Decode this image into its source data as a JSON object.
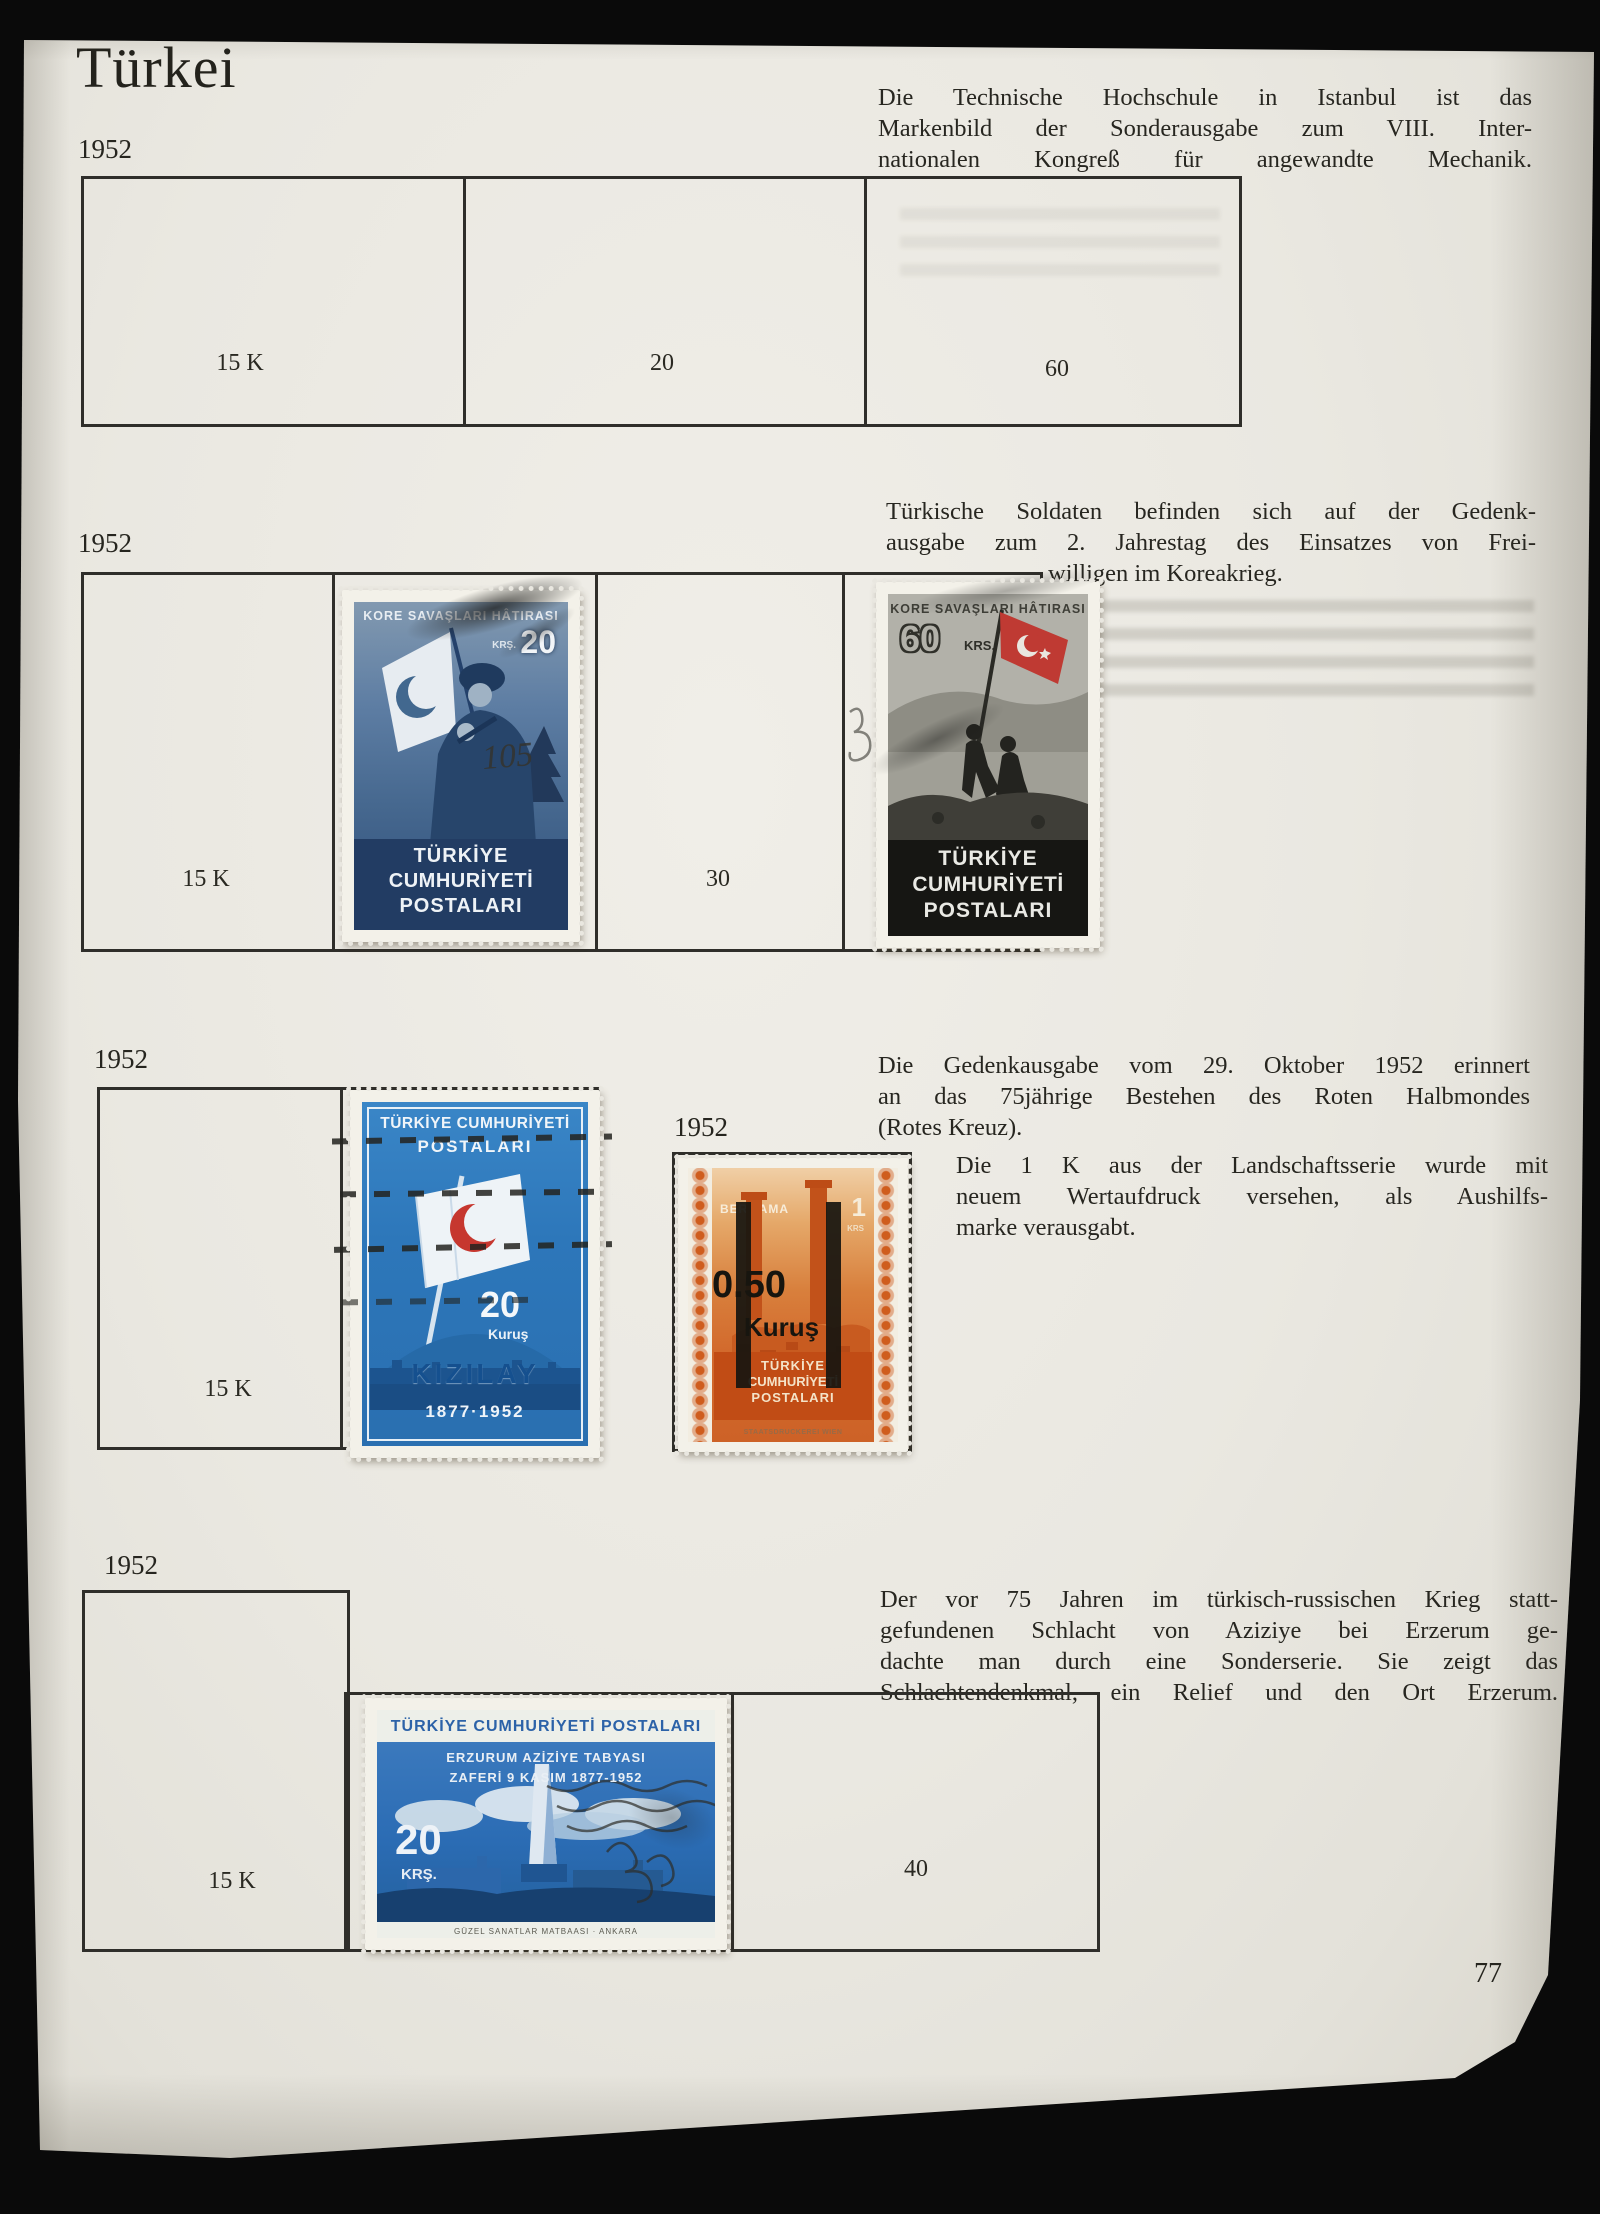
{
  "page": {
    "title": "Türkei",
    "number": "77"
  },
  "colors": {
    "paper": "#eae8e1",
    "ink": "#26251f",
    "box_line": "#2e2d29",
    "korea20_blue": "#4d6e96",
    "korea20_panel": "#223c63",
    "korea60_flag_red": "#bf3a33",
    "korea60_panel": "#171714",
    "kizilay_blue": "#2f7cc0",
    "crescent_red": "#c6372f",
    "bergama_orange": "#d55d22",
    "bergama_panel": "#c14c15",
    "erzurum_blue": "#2b6cb4"
  },
  "sections": {
    "s1": {
      "year": "1952",
      "para": [
        "Die Technische Hochschule in Istanbul ist das",
        "Markenbild der Sonderausgabe zum VIII. Inter-",
        "nationalen Kongreß für angewandte Mechanik."
      ],
      "cell1": "15 K",
      "cell2": "20",
      "cell3": "60"
    },
    "s2": {
      "year": "1952",
      "para": [
        "Türkische Soldaten befinden sich auf der Gedenk-",
        "ausgabe zum 2. Jahrestag des Einsatzes von Frei-",
        "willigen im Koreakrieg."
      ],
      "cell1": "15 K",
      "cell2": "30"
    },
    "s3": {
      "year": "1952",
      "para": [
        "Die Gedenkausgabe vom 29. Oktober 1952 erinnert",
        "an das 75jährige Bestehen des Roten Halbmondes",
        "(Rotes Kreuz)."
      ],
      "year2": "1952",
      "para2": [
        "Die 1 K aus der Landschaftsserie wurde mit",
        "neuem Wertaufdruck versehen, als Aushilfs-",
        "marke verausgabt."
      ],
      "cell1": "15 K"
    },
    "s4": {
      "year": "1952",
      "para": [
        "Der vor 75 Jahren im türkisch-russischen Krieg statt-",
        "gefundenen Schlacht von Aziziye bei Erzerum ge-",
        "dachte man durch eine Sonderserie.  Sie zeigt das",
        "Schlachtendenkmal, ein Relief und den Ort Erzerum."
      ],
      "cell1": "15 K",
      "cell2": "40"
    }
  },
  "stamps": {
    "korea20": {
      "header": "KORE SAVAŞLARI HÂTIRASI",
      "krs": "KRŞ.",
      "value": "20",
      "footer1": "TÜRKİYE",
      "footer2": "CUMHURİYETİ",
      "footer3": "POSTALARI",
      "cancel": "105"
    },
    "korea60": {
      "header": "KORE SAVAŞLARI HÂTIRASI",
      "value": "60",
      "krs": "KRS.",
      "footer1": "TÜRKİYE",
      "footer2": "CUMHURİYETİ",
      "footer3": "POSTALARI"
    },
    "kizilay": {
      "top1": "TÜRKİYE CUMHURİYETİ",
      "top2": "POSTALARI",
      "value": "20",
      "currency": "Kuruş",
      "name": "KIZILAY",
      "years": "1877·1952"
    },
    "bergama": {
      "place": "BERGAMA",
      "value": "1",
      "krs": "KRS",
      "op_value": "0.50",
      "op_currency": "Kuruş",
      "footer1": "TÜRKİYE",
      "footer2": "CUMHURİYETİ",
      "footer3": "POSTALARI",
      "imprint": "STAATSDRUCKEREI WIEN"
    },
    "erzurum": {
      "top": "TÜRKİYE CUMHURİYETİ POSTALARI",
      "line1": "ERZURUM AZİZİYE TABYASI",
      "line2": "ZAFERİ 9 KASIM 1877-1952",
      "value": "20",
      "krs": "KRŞ.",
      "imprint": "GÜZEL SANATLAR MATBAASI · ANKARA"
    }
  }
}
